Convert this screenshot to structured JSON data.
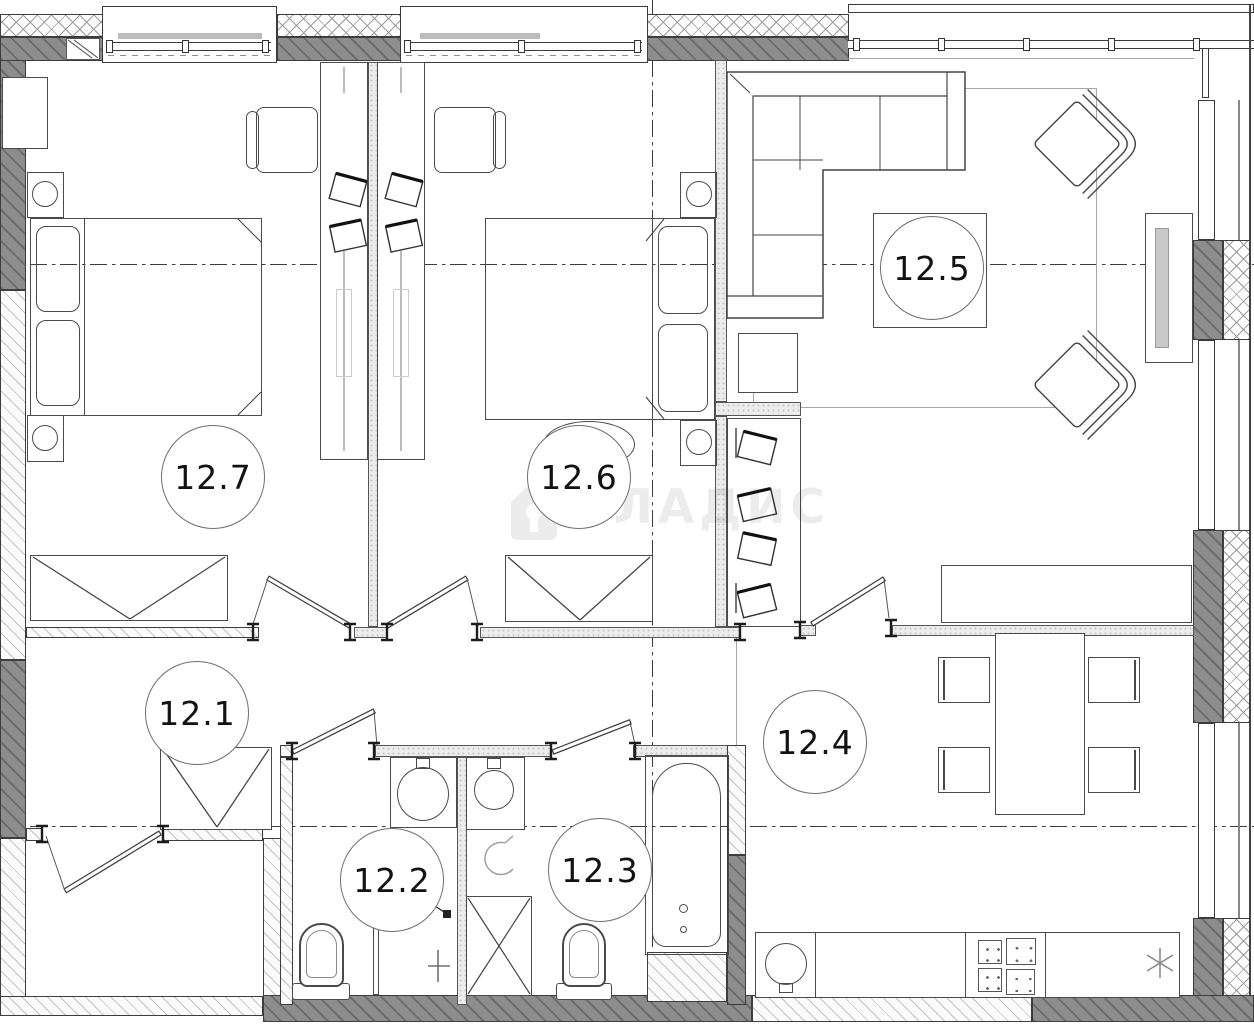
{
  "plan_type": "apartment floor plan drawing",
  "watermark": {
    "text": "ВЛАДИС",
    "icon": "house-icon"
  },
  "rooms": [
    {
      "id": "room-12-1",
      "label": "12.1",
      "type": "hallway"
    },
    {
      "id": "room-12-2",
      "label": "12.2",
      "type": "wc"
    },
    {
      "id": "room-12-3",
      "label": "12.3",
      "type": "bathroom"
    },
    {
      "id": "room-12-4",
      "label": "12.4",
      "type": "kitchen-dining"
    },
    {
      "id": "room-12-5",
      "label": "12.5",
      "type": "living-room"
    },
    {
      "id": "room-12-6",
      "label": "12.6",
      "type": "bedroom"
    },
    {
      "id": "room-12-7",
      "label": "12.7",
      "type": "bedroom"
    }
  ],
  "colors": {
    "wall_dark": "#8d8d8d",
    "line": "#3d3d3d",
    "hatch_light": "#c3c3c3",
    "watermark": "rgba(40,40,40,0.085)"
  }
}
